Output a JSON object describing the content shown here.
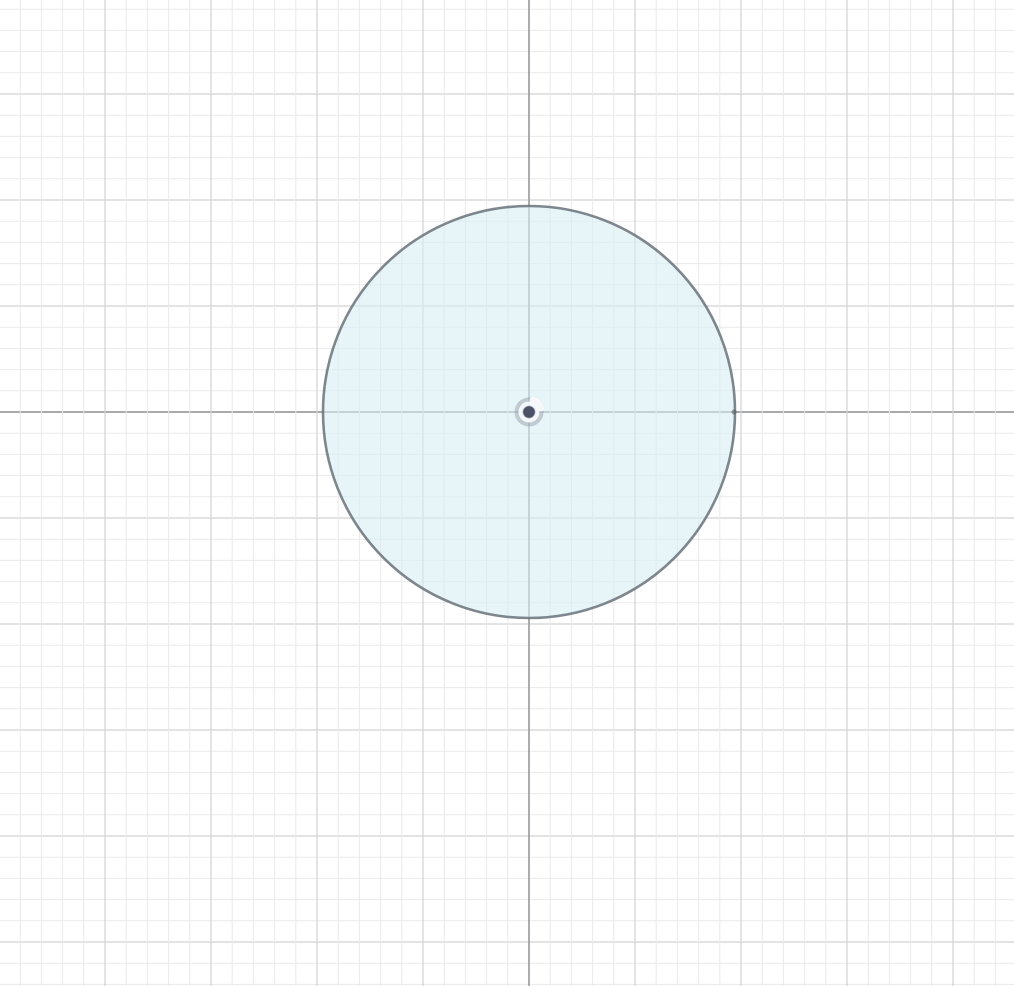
{
  "app": {
    "view": "sketch-canvas",
    "background_color": "#ffffff"
  },
  "canvas": {
    "width": 1014,
    "height": 986,
    "grid": {
      "minor_spacing": 21.2,
      "major_every": 5,
      "minor_color": "#eaeaea",
      "major_color": "#d2d2d2",
      "axis_color": "#9b9ea1",
      "minor_width": 1,
      "major_width": 1.2,
      "axis_width": 1.7,
      "origin_x": 529,
      "origin_y": 412
    },
    "shapes": [
      {
        "type": "circle",
        "name": "sketch-circle",
        "cx": 529,
        "cy": 412,
        "r": 206,
        "stroke": "#68727a",
        "stroke_width": 2.6,
        "stroke_opacity": 0.85,
        "fill": "rgba(215, 236, 243, 0.6)"
      }
    ],
    "origin_marker": {
      "name": "origin-point",
      "x": 529,
      "y": 412,
      "halo_radius": 14.5,
      "halo_color": "rgba(138, 144, 157, 0.42)",
      "notch_color": "rgba(255, 255, 255, 0.85)",
      "ring_radius": 8.5,
      "ring_color": "rgba(248, 250, 252, 0.95)",
      "ring_width": 4,
      "dot_radius": 5.8,
      "dot_color": "#4b5166"
    },
    "edge_points": [
      {
        "name": "circle-quadrant-point",
        "x": 734,
        "y": 412,
        "radius": 2.6,
        "color": "rgba(85, 92, 100, 0.55)"
      }
    ]
  }
}
